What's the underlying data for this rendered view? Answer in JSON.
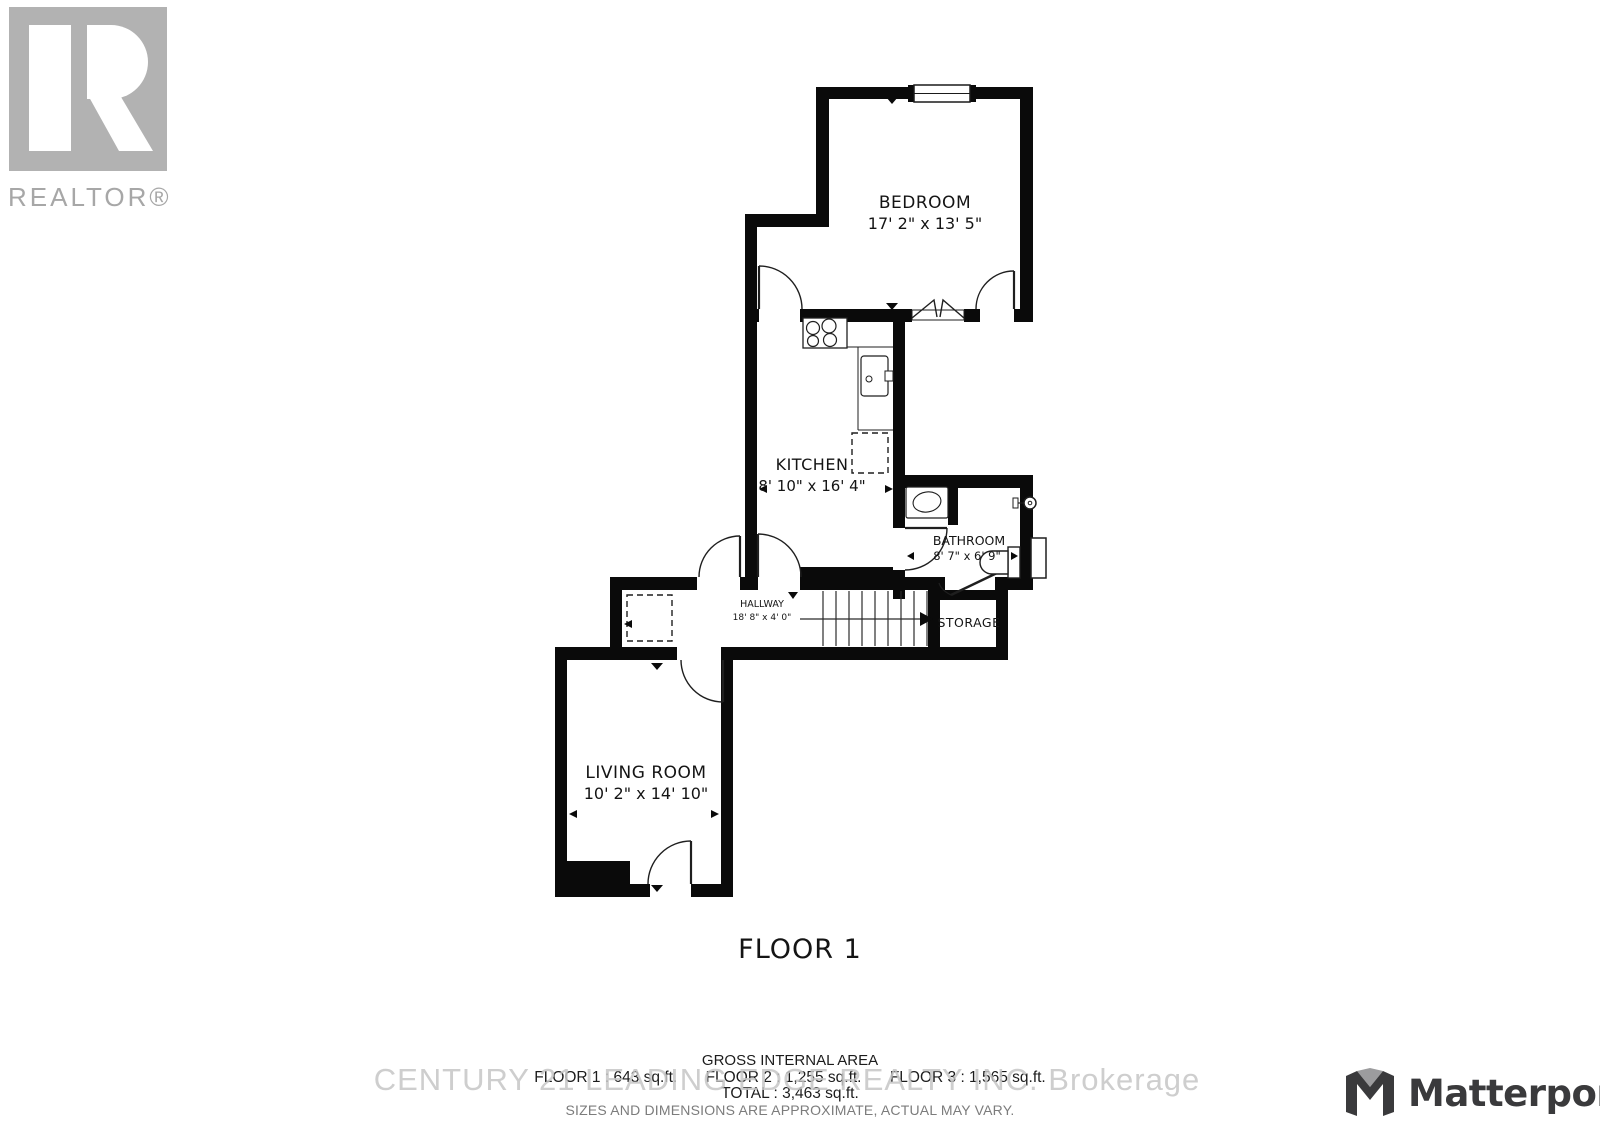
{
  "realtor_logo": {
    "text": "REALTOR®"
  },
  "rooms": {
    "bedroom": {
      "name": "BEDROOM",
      "dims": "17' 2\" x 13' 5\""
    },
    "kitchen": {
      "name": "KITCHEN",
      "dims": "8' 10\" x 16' 4\""
    },
    "bathroom": {
      "name": "BATHROOM",
      "dims": "8' 7\" x 6' 9\""
    },
    "hallway": {
      "name": "HALLWAY",
      "dims": "18' 8\" x 4' 0\""
    },
    "storage": {
      "name": "STORAGE"
    },
    "living": {
      "name": "LIVING ROOM",
      "dims": "10' 2\" x 14' 10\""
    }
  },
  "floor_title": "FLOOR 1",
  "summary": {
    "heading": "GROSS INTERNAL AREA",
    "floor1": "FLOOR 1 :  643 sq.ft.",
    "floor2": "FLOOR 2 :  1,255 sq.ft.",
    "floor3": "FLOOR 3 :  1,565 sq.ft.",
    "total": "TOTAL :  3,463 sq.ft.",
    "disclaimer": "SIZES AND DIMENSIONS ARE APPROXIMATE, ACTUAL MAY VARY."
  },
  "watermark": "CENTURY 21 LEADING EDGE REALTY INC. Brokerage",
  "matterport": {
    "text": "Matterport"
  },
  "colors": {
    "wall": "#0a0a0a",
    "logo_gray": "#b2b2b2",
    "text_gray": "#7c7c7c",
    "watermark_gray": "#c5c5c5",
    "matterport_dark": "#3a3a3c",
    "matterport_gray": "#9c9c9e"
  }
}
